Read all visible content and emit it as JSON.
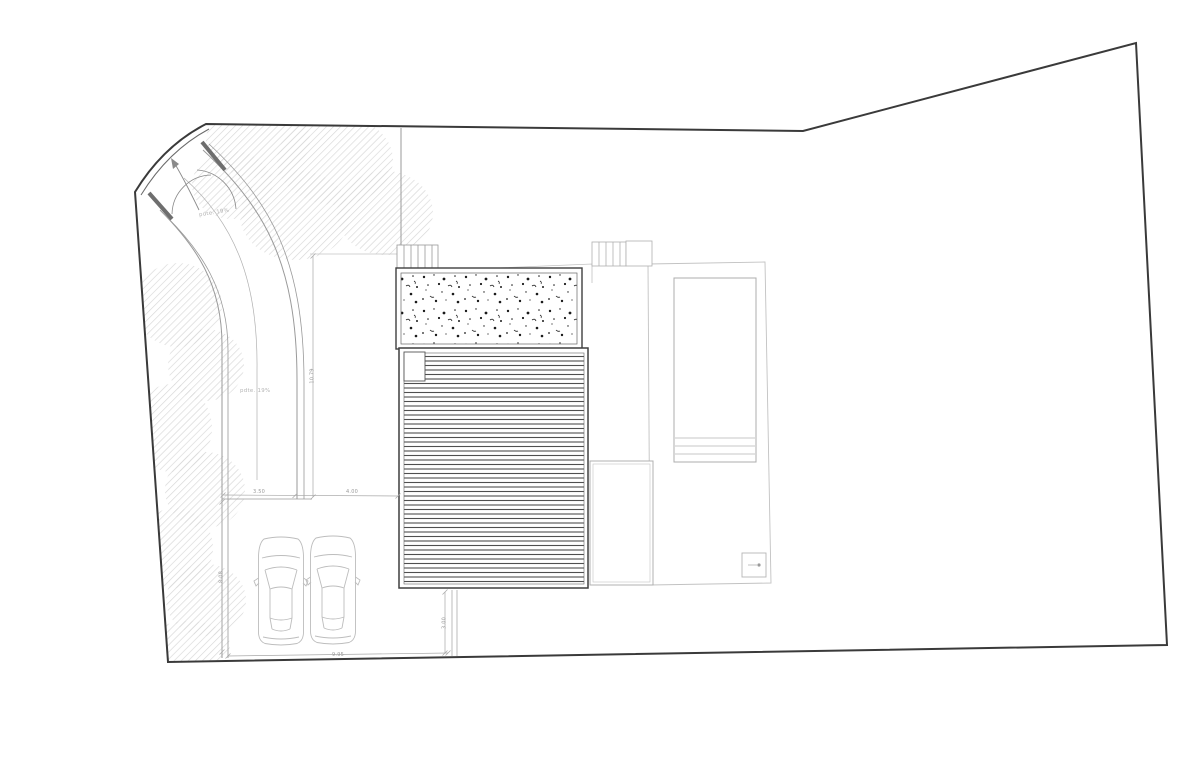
{
  "drawing": {
    "type": "architectural-site-plan",
    "labels": {
      "slope_gate": "pdte. 19%",
      "slope_drive": "pdte. 19%"
    },
    "dimensions": {
      "drive_width": "3.50",
      "drive_to_house": "4.00",
      "drive_length": "10.79",
      "parking_depth": "8.08",
      "parking_width": "9.95",
      "deck_offset": "3.00"
    },
    "colors": {
      "paper": "#ffffff",
      "boundary": "#3a3a3a",
      "building_line": "#3f3f3f",
      "deck_stripe": "#4f4f4f",
      "gravel_dot": "#1a1a1a",
      "light_line": "#c0c0c0",
      "dimension": "#9a9a9a",
      "foliage": "#d7d7d7"
    }
  }
}
